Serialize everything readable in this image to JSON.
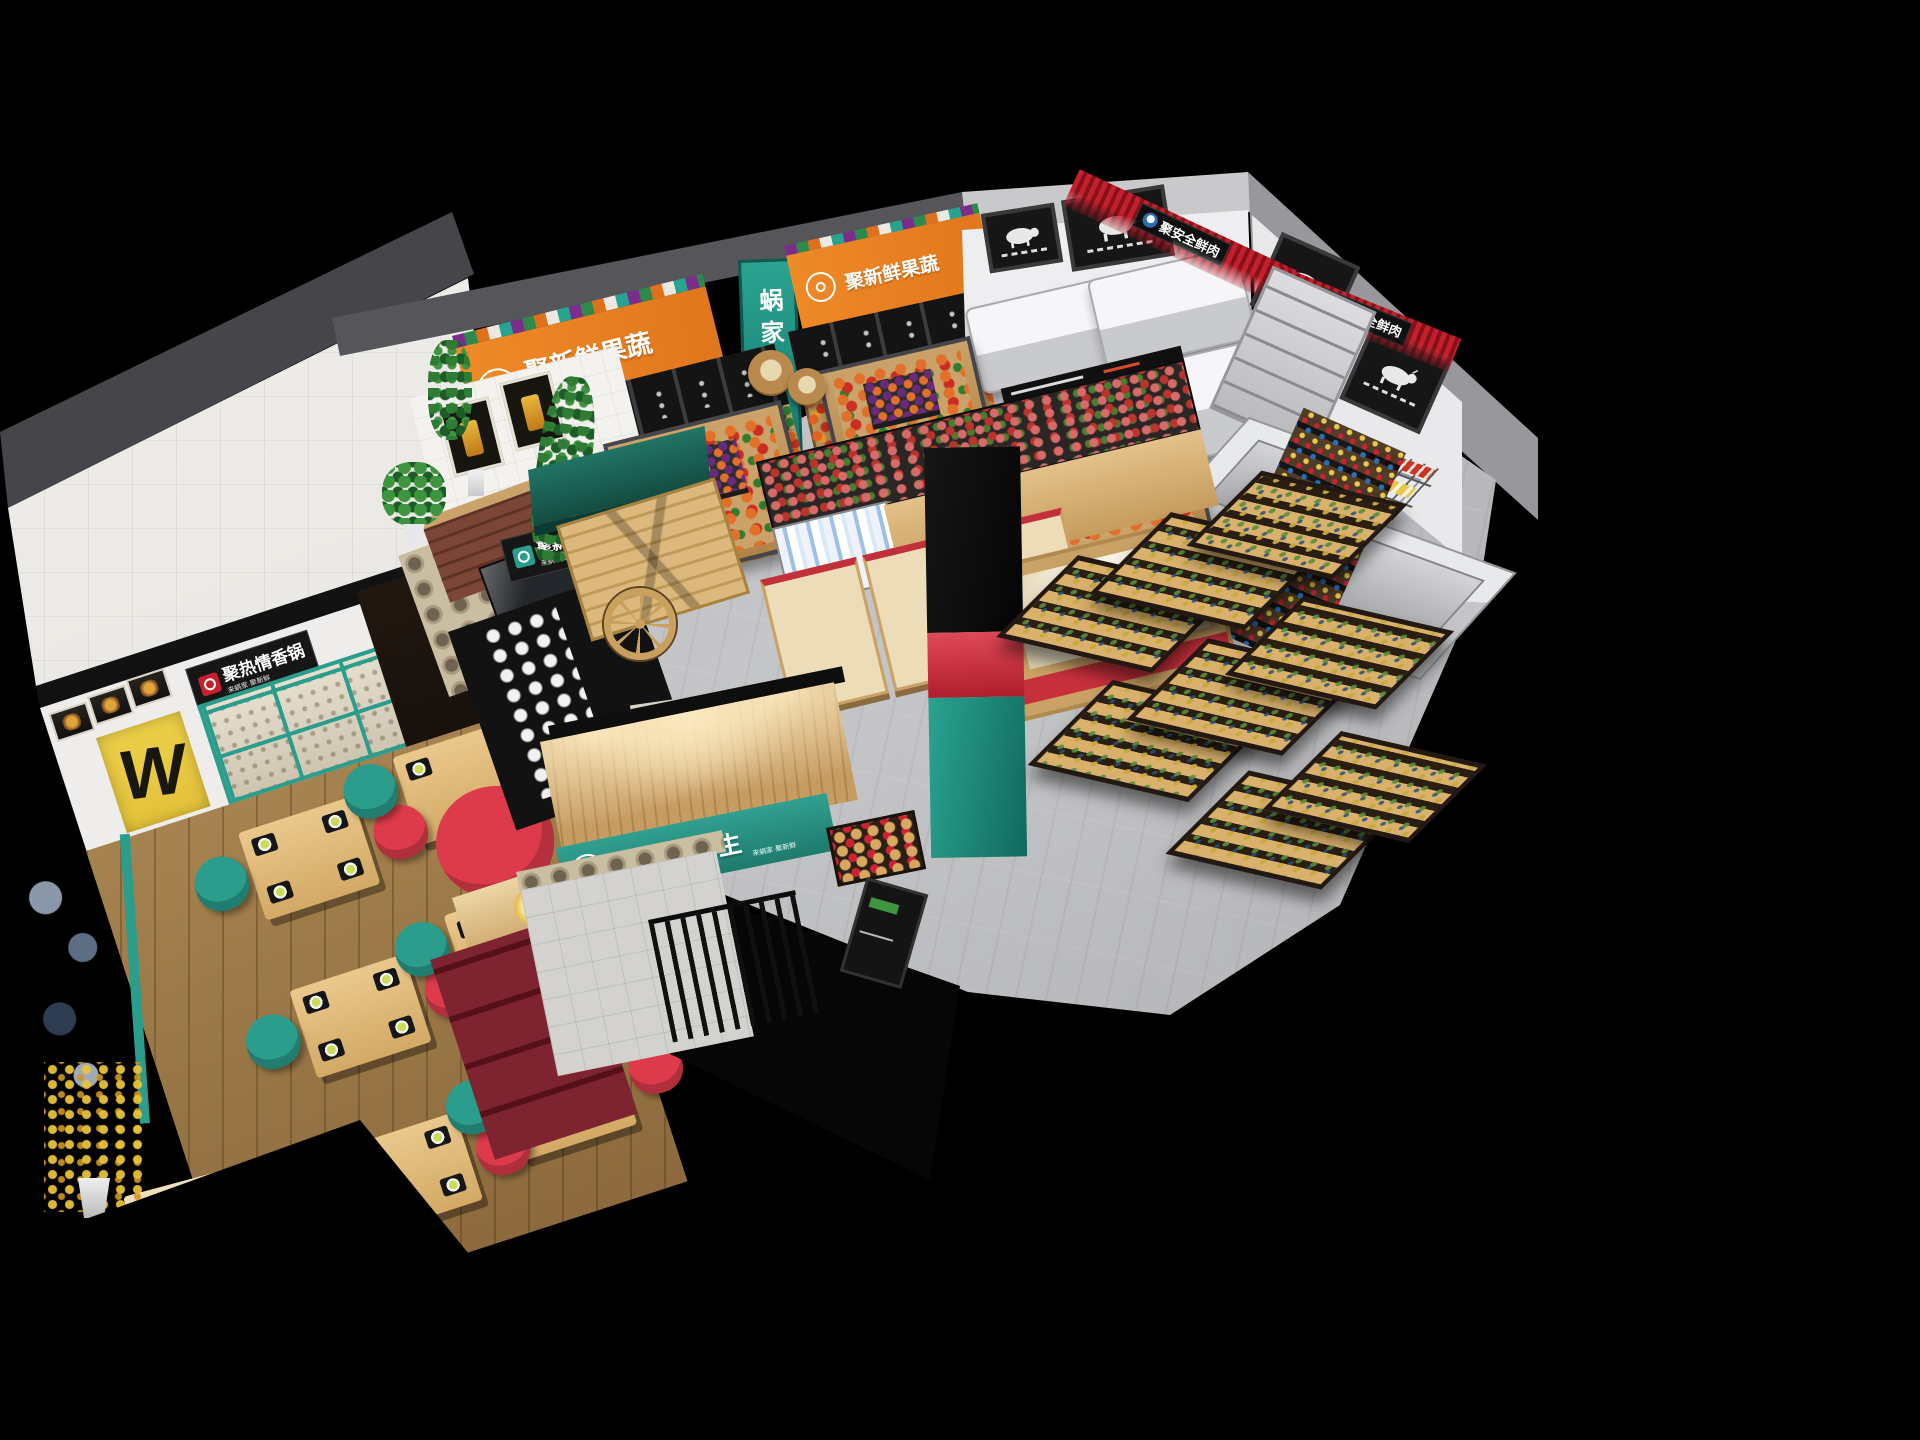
{
  "scene": {
    "signs": {
      "produce_banner_left": "聚新鲜果蔬",
      "produce_banner_right": "聚新鲜果蔬",
      "brand_vertical": "蜗家",
      "light_food": "聚新鲜轻食",
      "hotpot": "聚热情香锅",
      "fresh_meat_back": "聚安全鲜肉",
      "fresh_meat_right": "聚安全鲜肉",
      "tagline": "来蜗家·聚新鲜",
      "wall_letter": "W"
    },
    "entrance": {
      "brand_en_top": "MR'",
      "brand_en_bottom": "WO",
      "brand_cn": "蜗家鲜生",
      "tagline": "来蜗家·聚新鲜"
    }
  },
  "colors": {
    "orange": "#e0761c",
    "teal": "#2a9d8d",
    "teal_dark": "#1c6e62",
    "red": "#dd3b4b",
    "fringe_red": "#c01f2d",
    "meat_logo_blue": "#2a6fb8",
    "yellow": "#e4c23a",
    "wood": "#d2a96c",
    "wood_dark": "#8a5f35",
    "floor_gray": "#b6b7ba",
    "dining_wood": "#a5824f",
    "board_black": "#161616",
    "wall_white": "#efedeb"
  }
}
